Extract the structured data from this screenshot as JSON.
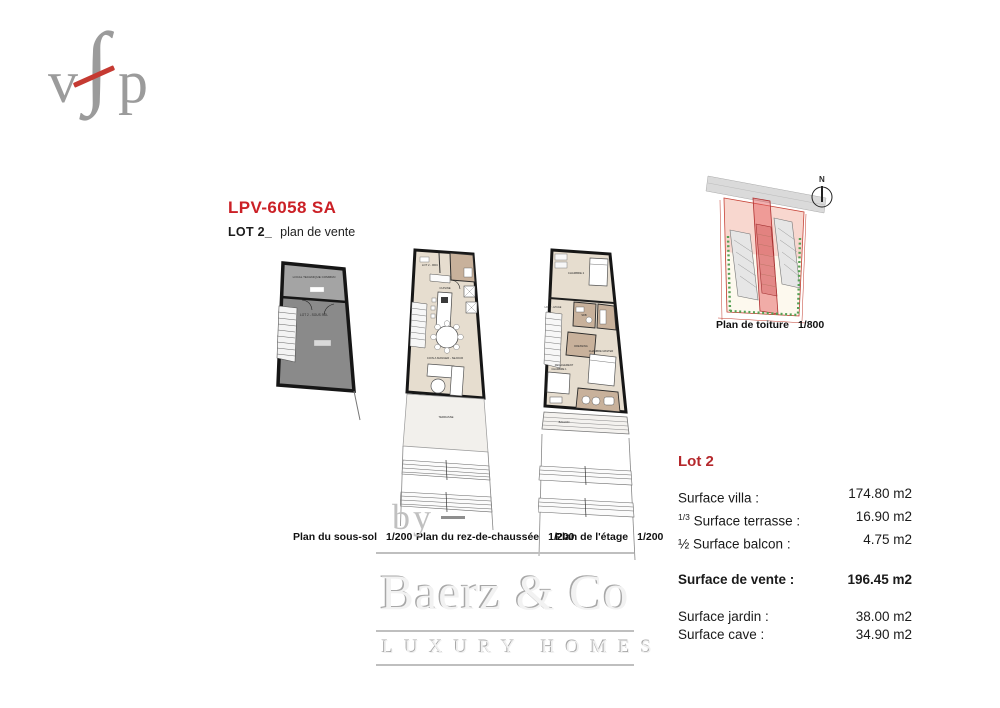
{
  "logo": {
    "v": "v",
    "f": "∫",
    "p": "p"
  },
  "header": {
    "project_code": "LPV-6058 SA",
    "lot_label": "LOT 2_",
    "plan_type": "plan de vente"
  },
  "plans": {
    "sous_sol": {
      "caption": "Plan du sous-sol",
      "scale": "1/200",
      "rooms": {
        "local_technique": "LOCAL TECHNIQUE COMMUN",
        "lot": "LOT 2 - SOUS SOL"
      }
    },
    "rdc": {
      "caption": "Plan du rez-de-chaussée",
      "scale": "1/200",
      "rooms": {
        "lot": "LOT 2 - RDC",
        "cuisine": "CUISINE",
        "sejour": "COIN A MANGER - SEJOUR",
        "terrasse": "TERRASSE"
      }
    },
    "etage": {
      "caption": "Plan de l'étage",
      "scale": "1/200",
      "rooms": {
        "lot": "LOT 2 - ETAGE",
        "chambre2": "CHAMBRE 2",
        "sdb": "SDB",
        "dressing": "DRESSING",
        "degagement": "DEGAGEMENT",
        "chambre1": "CHAMBRE 1",
        "master": "CHAMBRE MASTER",
        "balcon": "BALCON"
      }
    },
    "toiture": {
      "caption": "Plan de toiture",
      "scale": "1/800",
      "north": "N"
    }
  },
  "surfaces": {
    "title": "Lot 2",
    "rows": [
      {
        "prefix": "",
        "label": "Surface villa :",
        "value": "174.80 m2"
      },
      {
        "prefix": "1/3",
        "label": " Surface terrasse :",
        "value": "16.90 m2"
      },
      {
        "prefix": "",
        "label": "½ Surface balcon :",
        "value": "4.75 m2"
      }
    ],
    "total": {
      "label": "Surface de vente :",
      "value": "196.45 m2"
    },
    "extra_rows": [
      {
        "label": "Surface jardin :",
        "value": "38.00 m2"
      },
      {
        "label": "Surface cave :",
        "value": "34.90 m2"
      }
    ]
  },
  "watermark": {
    "by": "by",
    "brand": "Baerz & Co",
    "tagline": "LUXURY HOMES"
  },
  "colors": {
    "accent_red": "#cb2026",
    "logo_gray": "#9b9b9b",
    "floor_beige": "#e6ddcf",
    "wet_brown": "#c8b19b",
    "basement_gray": "#8a8a8a",
    "watermark_gray": "#c0c0c0"
  }
}
